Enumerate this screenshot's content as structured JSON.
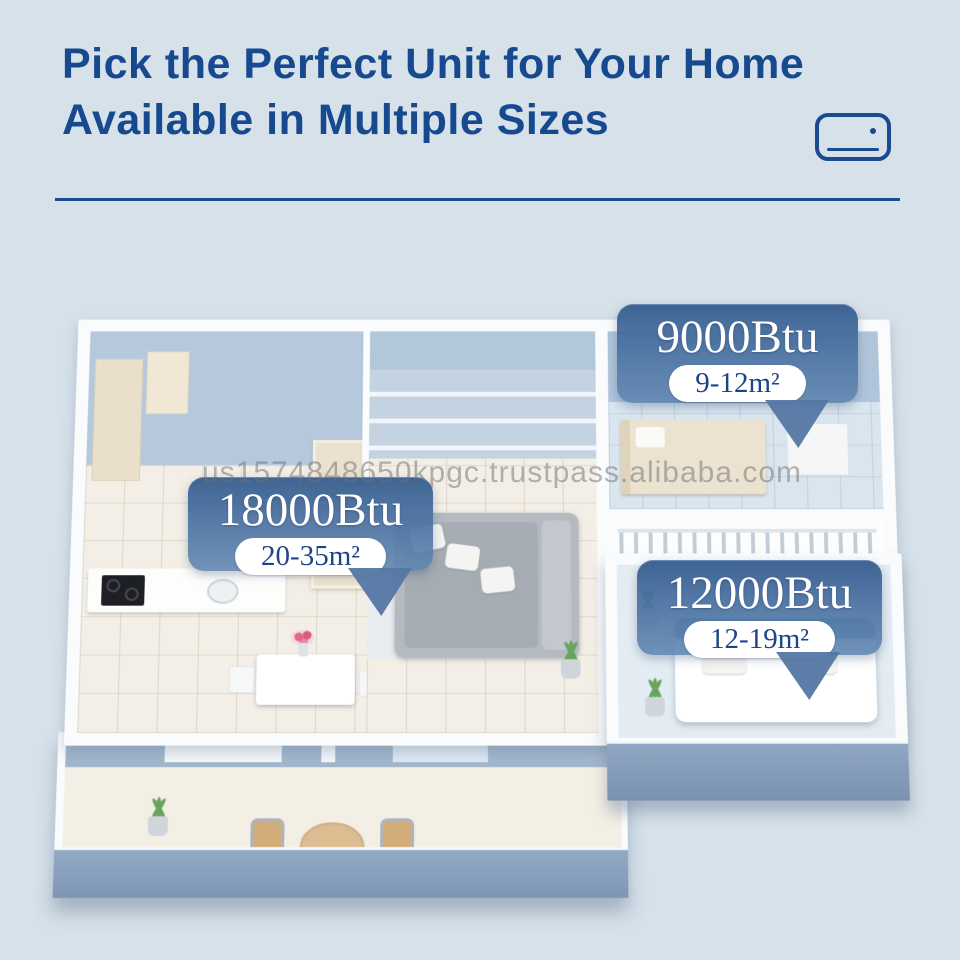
{
  "header": {
    "title_line1": "Pick the Perfect Unit for Your Home",
    "title_line2": "Available in Multiple Sizes",
    "icon": "air-conditioner-icon"
  },
  "callouts": [
    {
      "room": "small-bedroom",
      "btu": "9000Btu",
      "area": "9-12m²"
    },
    {
      "room": "living-room",
      "btu": "18000Btu",
      "area": "20-35m²"
    },
    {
      "room": "master-bedroom",
      "btu": "12000Btu",
      "area": "12-19m²"
    }
  ],
  "watermark": "us1574848650kpgc.trustpass.alibaba.com",
  "colors": {
    "background": "#d6e1ea",
    "title_blue": "#17498f",
    "callout_blue": "#4a71a1",
    "pill_text_navy": "#1d4586",
    "wall_white": "#f9fbfd",
    "wall_face_blue": "#8aa1bf",
    "interior_wall_blue": "#b6c9dc",
    "floor_cream": "#f3efe5"
  }
}
